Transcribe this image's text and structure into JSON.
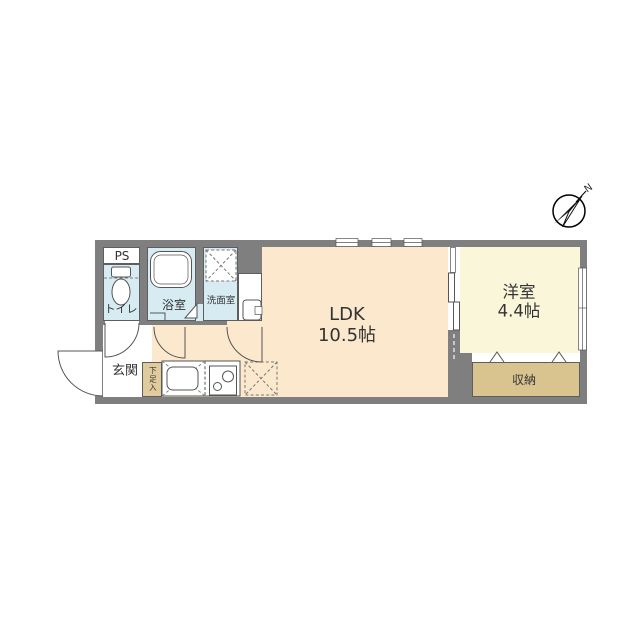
{
  "compass": {
    "north_label": "N"
  },
  "rooms": {
    "ps": {
      "label": "PS"
    },
    "toilet": {
      "label": "トイレ"
    },
    "bath": {
      "label": "浴室"
    },
    "washroom": {
      "label": "洗面室"
    },
    "ldk": {
      "label": "LDK",
      "size": "10.5帖"
    },
    "western_room": {
      "label": "洋室",
      "size": "4.4帖"
    },
    "storage": {
      "label": "収納"
    },
    "entrance": {
      "label": "玄関"
    },
    "shoe_cabinet": {
      "label": "下足入"
    }
  },
  "colors": {
    "outside": "#ffffff",
    "wall": "#7f7f7f",
    "ldk_floor": "#fce8cd",
    "western_floor": "#faf6da",
    "wet_floor": "#d7ebf3",
    "storage_floor": "#d9c38f",
    "shoe_floor": "#e0cb9c",
    "label": "#333333",
    "line": "#555555"
  }
}
